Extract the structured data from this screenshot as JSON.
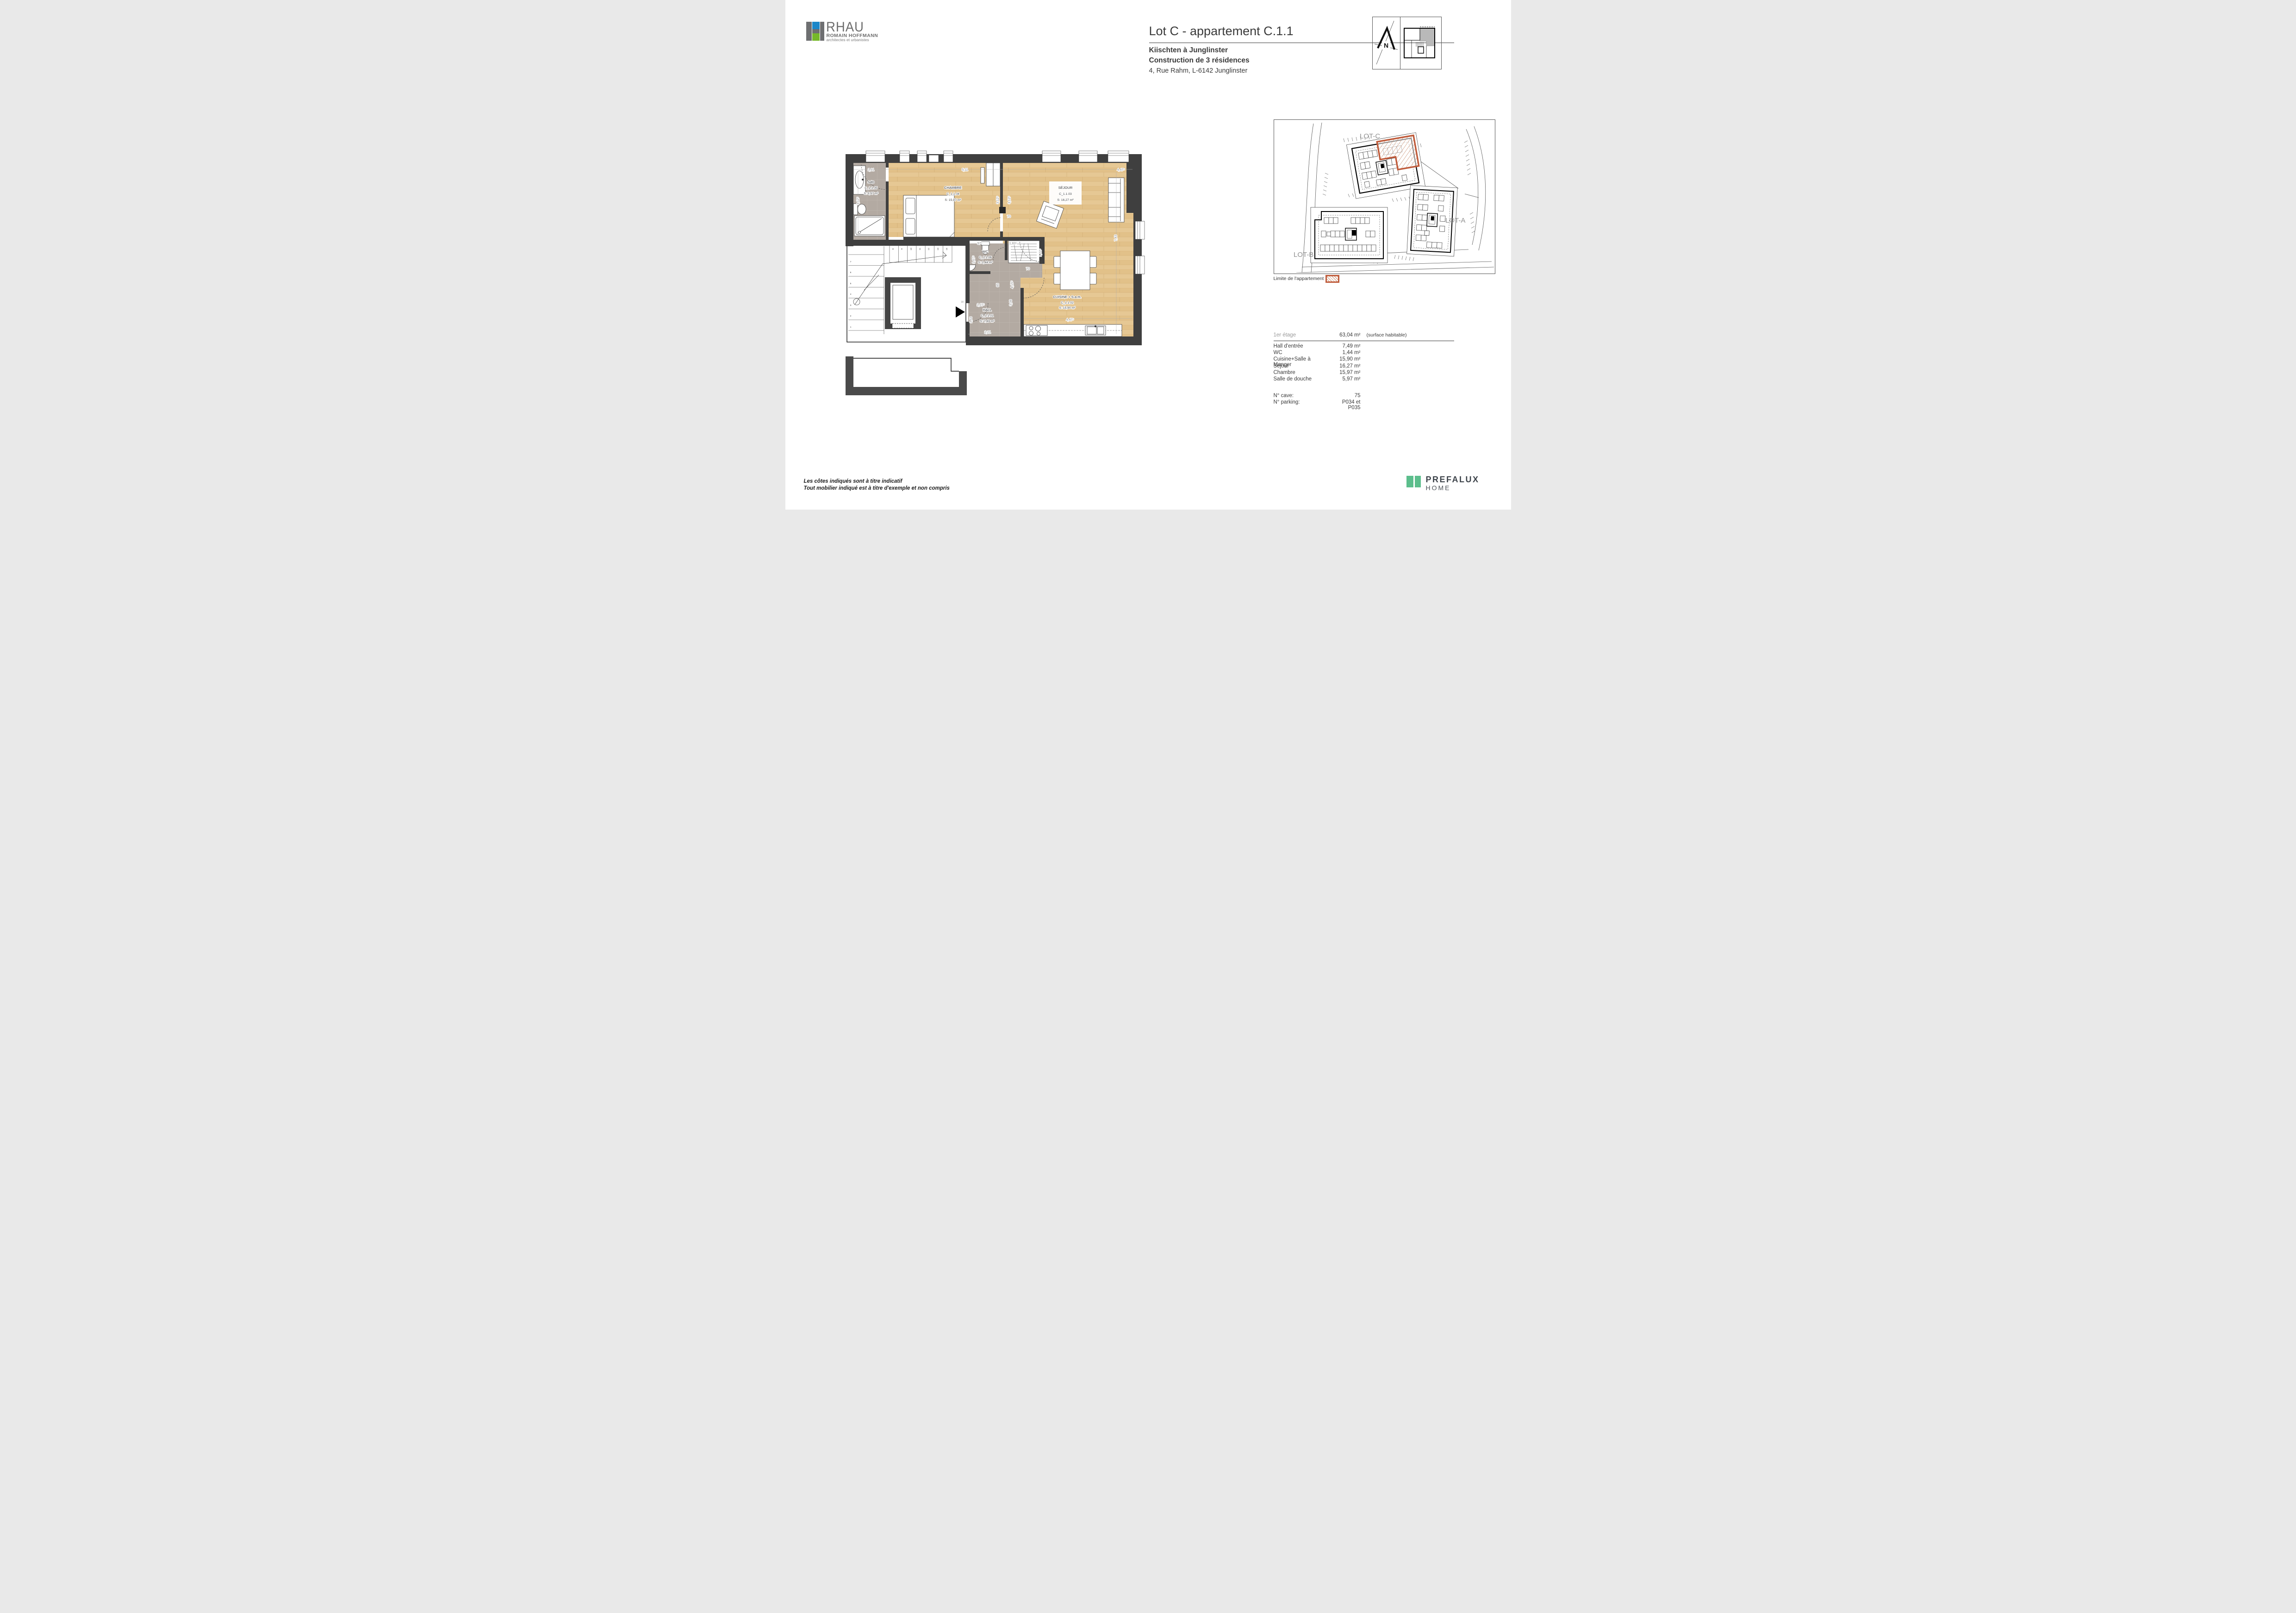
{
  "header": {
    "logo": {
      "acronym": "RHAU",
      "name": "ROMAIN HOFFMANN",
      "profession": "architectes et urbanistes"
    },
    "title": "Lot C - appartement C.1.1",
    "project_name": "Kiischten à Junglinster",
    "project_desc": "Construction de 3 résidences",
    "address": "4, Rue Rahm, L-6142 Junglinster",
    "north_label": "N"
  },
  "floorplan": {
    "rooms": {
      "sdd": {
        "name": "SdD",
        "code": "C_1.1.05",
        "area": "S: 5,97 m²"
      },
      "chambre": {
        "name": "CHAMBRE",
        "code": "C_1.1.04",
        "area": "S: 15,97 m²"
      },
      "sejour": {
        "name": "SÉJOUR",
        "code": "C_1.1.03",
        "area": "S: 16,27 m²"
      },
      "wc": {
        "name": "WC",
        "code": "C_1.1.06",
        "area": "S: 1,44 m²"
      },
      "hall": {
        "name": "HALL",
        "code": "C_1.1.01",
        "area": "S: 7,49 m²"
      },
      "cuisine": {
        "name": "CUISINE + S.a.m.",
        "code": "C_1.1.02",
        "area": "S: 15,90 m²"
      }
    },
    "dims": {
      "d191": "1,91",
      "d511": "5,11",
      "d447a": "4,47⁵",
      "d447b": "4,47⁵",
      "d312a": "3,12⁵",
      "d312b": "3,12⁵",
      "d312c": "3,12⁵",
      "d70a": "70",
      "d70b": "70",
      "d975": "97⁵",
      "d183": "1,83⁵",
      "d167": "1,67⁵",
      "d122": "1,22⁵",
      "d85": "85",
      "d415": "4,15⁵",
      "d308": "3,08",
      "d107": "1,07⁵",
      "d163": "1,63",
      "d221": "2,21",
      "d743": "7,43",
      "d18": "18"
    },
    "stairs": [
      "1",
      "2",
      "3",
      "4",
      "5",
      "6",
      "7",
      "8",
      "9",
      "10",
      "11",
      "12",
      "13",
      "14"
    ]
  },
  "siteplan": {
    "lots": {
      "c": "LOT-C",
      "a": "LOT-A",
      "b": "LOT-B"
    },
    "legend": "Limite de l'appartement"
  },
  "table": {
    "floor": "1er étage",
    "total": "63,04 m²",
    "note": "(surface habitable)",
    "rows": [
      {
        "label": "Hall d'entrée",
        "value": "7,49 m²"
      },
      {
        "label": "WC",
        "value": "1,44 m²"
      },
      {
        "label": "Cuisine+Salle à Manger",
        "value": "15,90 m²"
      },
      {
        "label": "Séjour",
        "value": "16,27 m²"
      },
      {
        "label": "Chambre",
        "value": "15,97 m²"
      },
      {
        "label": "Salle de douche",
        "value": "5,97 m²"
      }
    ],
    "extras": [
      {
        "label": "N° cave:",
        "value": "75"
      },
      {
        "label": "N° parking:",
        "value": "P034 et P035"
      }
    ]
  },
  "footer": {
    "note1": "Les côtes indiqués sont à titre indicatif",
    "note2": "Tout mobilier indiqué est à titre d'exemple et non compris",
    "brand": "PREFALUX",
    "brand_line": "HOME"
  },
  "colors": {
    "wall": "#3f3f3f",
    "wood": "#e6c894",
    "tile": "#b3aaa2",
    "accent": "#bf5b3b",
    "logo_blue": "#1b87c9",
    "logo_green": "#76b82a",
    "brand_green": "#5cbe8c"
  }
}
